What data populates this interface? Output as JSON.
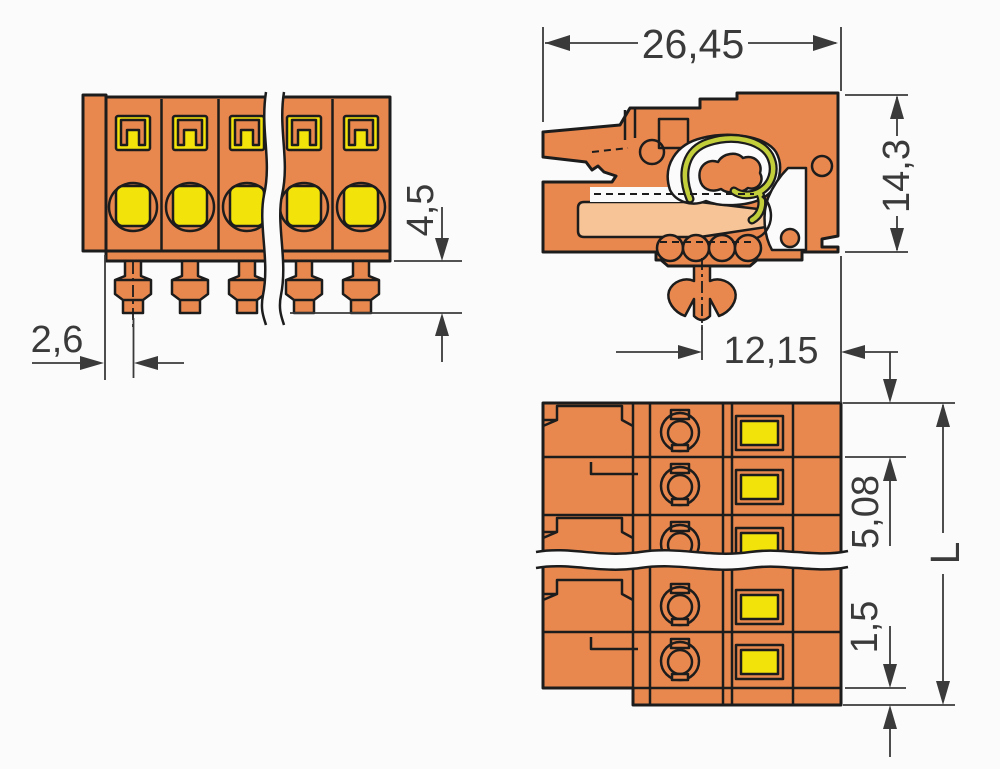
{
  "drawing": {
    "dims": {
      "overall_width": "26,45",
      "overall_height": "14,3",
      "pin_protrusion": "4,5",
      "edge_to_first_pole": "2,6",
      "foot_to_front": "12,15",
      "pole_pitch": "5,08",
      "bottom_step": "1,5",
      "total_length": "L"
    }
  },
  "colors": {
    "housing": "#E8884F",
    "insert": "#F2E30A",
    "spring": "#C2CE3A",
    "cavity_light": "#F6C497",
    "outline": "#1C1C1C",
    "dimension": "#3A3A3A",
    "background": "#FBFBFB"
  }
}
